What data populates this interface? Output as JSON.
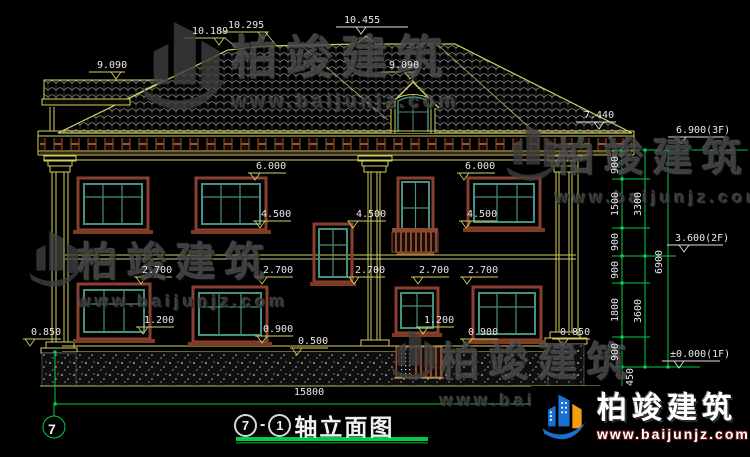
{
  "title": {
    "axis_start": "7",
    "separator": "-",
    "axis_end": "1",
    "text": "轴立面图"
  },
  "dims": {
    "total_width": "15800",
    "axis_bubble": "7"
  },
  "watermark": {
    "brand": "柏竣建筑",
    "url": "www.baijunjz.com"
  },
  "logo": {
    "brand": "柏竣建筑",
    "url": "www.baijunjz.com"
  },
  "colors": {
    "cad_yellow": "#cfcf5f",
    "dim_green": "#00cc44",
    "frame_teal": "#46907e",
    "frame_brown": "#8a4030",
    "text_white": "#e8e8e8",
    "watermark_gray": "#4a4a4a",
    "logo_blue": "#1a6fd4",
    "logo_orange": "#f59e0b"
  },
  "levels": [
    {
      "t": "9.090",
      "x": 97,
      "y": 61,
      "lw": 36,
      "tdx": 22
    },
    {
      "t": "10.189",
      "x": 192,
      "y": 27,
      "lw": 42,
      "tdx": 30
    },
    {
      "t": "10.295",
      "x": 228,
      "y": 21,
      "lw": 46,
      "tdx": 38
    },
    {
      "t": "10.455",
      "x": 344,
      "y": 16,
      "lw": 72,
      "tdx": 20,
      "c": "w"
    },
    {
      "t": "9.090",
      "x": 389,
      "y": 61,
      "lw": 32,
      "tdx": 24
    },
    {
      "t": "7.440",
      "x": 584,
      "y": 111,
      "lw": 40,
      "tdx": 18,
      "c": "w"
    },
    {
      "t": "6.900(3F)",
      "x": 676,
      "y": 126,
      "lw": 56,
      "tdx": 8,
      "c": "w"
    },
    {
      "t": "6.000",
      "x": 256,
      "y": 162
    },
    {
      "t": "6.000",
      "x": 465,
      "y": 162
    },
    {
      "t": "4.500",
      "x": 261,
      "y": 210
    },
    {
      "t": "4.500",
      "x": 356,
      "y": 210,
      "tdx": 0
    },
    {
      "t": "4.500",
      "x": 467,
      "y": 210
    },
    {
      "t": "3.600(2F)",
      "x": 675,
      "y": 234,
      "lw": 56,
      "tdx": 12,
      "c": "w"
    },
    {
      "t": "2.700",
      "x": 142,
      "y": 266
    },
    {
      "t": "2.700",
      "x": 263,
      "y": 266
    },
    {
      "t": "2.700",
      "x": 355,
      "y": 266
    },
    {
      "t": "2.700",
      "x": 419,
      "y": 266
    },
    {
      "t": "2.700",
      "x": 468,
      "y": 266
    },
    {
      "t": "1.200",
      "x": 144,
      "y": 316
    },
    {
      "t": "1.200",
      "x": 424,
      "y": 316
    },
    {
      "t": "0.900",
      "x": 263,
      "y": 325
    },
    {
      "t": "0.900",
      "x": 468,
      "y": 328
    },
    {
      "t": "0.850",
      "x": 31,
      "y": 328
    },
    {
      "t": "0.850",
      "x": 560,
      "y": 328,
      "tdx": 6
    },
    {
      "t": "0.500",
      "x": 298,
      "y": 337
    },
    {
      "t": "±0.000(1F)",
      "x": 670,
      "y": 350,
      "lw": 58,
      "tdx": 12,
      "c": "w"
    }
  ],
  "vdims": [
    {
      "t": "900",
      "x": 616,
      "y": 165
    },
    {
      "t": "1500",
      "x": 616,
      "y": 204
    },
    {
      "t": "900",
      "x": 616,
      "y": 242
    },
    {
      "t": "900",
      "x": 616,
      "y": 270
    },
    {
      "t": "1800",
      "x": 616,
      "y": 310
    },
    {
      "t": "900",
      "x": 616,
      "y": 352
    },
    {
      "t": "450",
      "x": 631,
      "y": 377
    },
    {
      "t": "3300",
      "x": 639,
      "y": 204
    },
    {
      "t": "3600",
      "x": 639,
      "y": 311
    },
    {
      "t": "6900",
      "x": 660,
      "y": 262
    }
  ]
}
